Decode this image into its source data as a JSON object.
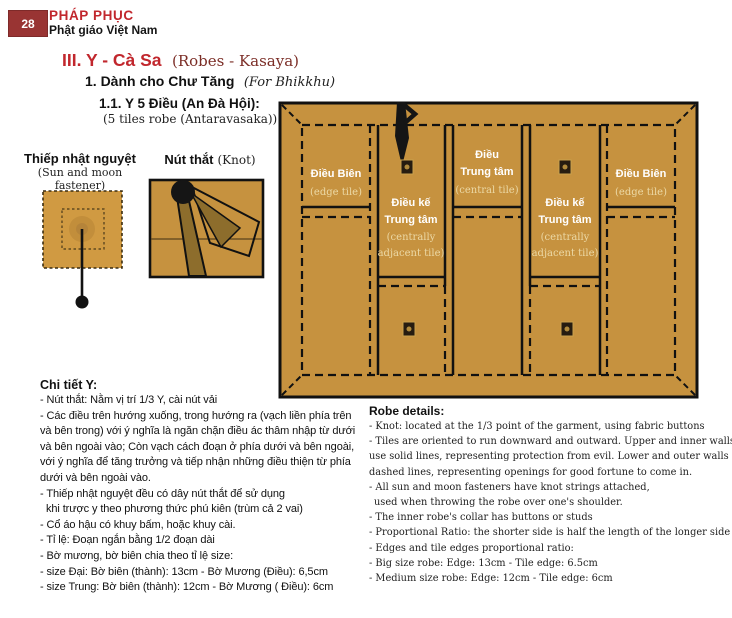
{
  "header": {
    "page_number": "28",
    "brand": "PHÁP PHỤC",
    "brand_sub": "Phật giáo Việt Nam"
  },
  "title": {
    "main": "III. Y - Cà Sa",
    "main_en": "(Robes - Kasaya)",
    "sub": "1. Dành cho Chư Tăng",
    "sub_en": "(For Bhikkhu)",
    "item": "1.1. Y 5 Điều (An Đà Hội):",
    "item_en": "(5 tiles robe (Antaravasaka))"
  },
  "figures": {
    "fastener": {
      "label": "Thiếp nhật nguyệt",
      "sublabel": "(Sun and moon fastener)"
    },
    "knot": {
      "label": "Nút thắt",
      "sublabel": "(Knot)"
    }
  },
  "robe": {
    "tiles": [
      {
        "l1": "Điều Biên",
        "l2": "(edge tile)"
      },
      {
        "l1": "Điều kế",
        "l2": "Trung tâm",
        "l3": "(centrally",
        "l4": "adjacent tile)"
      },
      {
        "l1": "Điều",
        "l2": "Trung tâm",
        "l3": "(central tile)"
      },
      {
        "l1": "Điều kế",
        "l2": "Trung tâm",
        "l3": "(centrally",
        "l4": "adjacent tile)"
      },
      {
        "l1": "Điều Biên",
        "l2": "(edge tile)"
      }
    ]
  },
  "details_vi": {
    "heading": "Chi tiết Y:",
    "lines": [
      "- Nút thắt: Nằm vị trí 1/3 Y, cài nút vải",
      "- Các điều trên hướng xuống, trong hướng ra (vạch liền phía trên",
      "và bên trong) với ý nghĩa là ngăn chặn điều ác thâm nhập từ dưới",
      "và bên ngoài vào; Còn vạch cách đoạn ở phía dưới và bên ngoài,",
      "với ý nghĩa để tăng trưởng và tiếp nhận những  điều thiện từ phía",
      "dưới và bên ngoài vào.",
      "- Thiếp nhật nguyệt đều có dây nút thắt để sử dụng",
      "khi trược y theo phương thức phú kiên (trùm cả 2 vai)",
      "- Cổ áo hậu có khuy bấm, hoặc khuy cài.",
      "- Tỉ lệ: Đoạn ngắn bằng 1/2 đoạn dài",
      "- Bờ mương, bờ biên chia theo tỉ lệ size:",
      "- size Đại: Bờ biên (thành): 13cm - Bờ Mương (Điều): 6,5cm",
      "- size Trung: Bờ biên (thành): 12cm - Bờ Mương ( Điều): 6cm"
    ]
  },
  "details_en": {
    "heading": "Robe details:",
    "lines": [
      "- Knot: located at the 1/3 point of the garment, using fabric buttons",
      "- Tiles are oriented to run downward and outward. Upper and inner walls",
      "use solid lines, representing protection from evil. Lower and outer walls used",
      "dashed lines, representing openings for good fortune to come in.",
      "- All sun and moon fasteners have knot strings attached,",
      "used when throwing the robe over one's shoulder.",
      "- The inner robe's collar has buttons or studs",
      "- Proportional Ratio: the shorter side is half the length of the longer side",
      "- Edges and tile edges proportional ratio:",
      "- Big size robe: Edge: 13cm - Tile edge: 6.5cm",
      "- Medium size robe: Edge: 12cm - Tile edge: 6cm"
    ]
  },
  "colors": {
    "accent_red": "#c1272d",
    "maroon_box": "#993433",
    "robe_tan": "#c6923f",
    "label_cream": "#ecd9a6"
  }
}
